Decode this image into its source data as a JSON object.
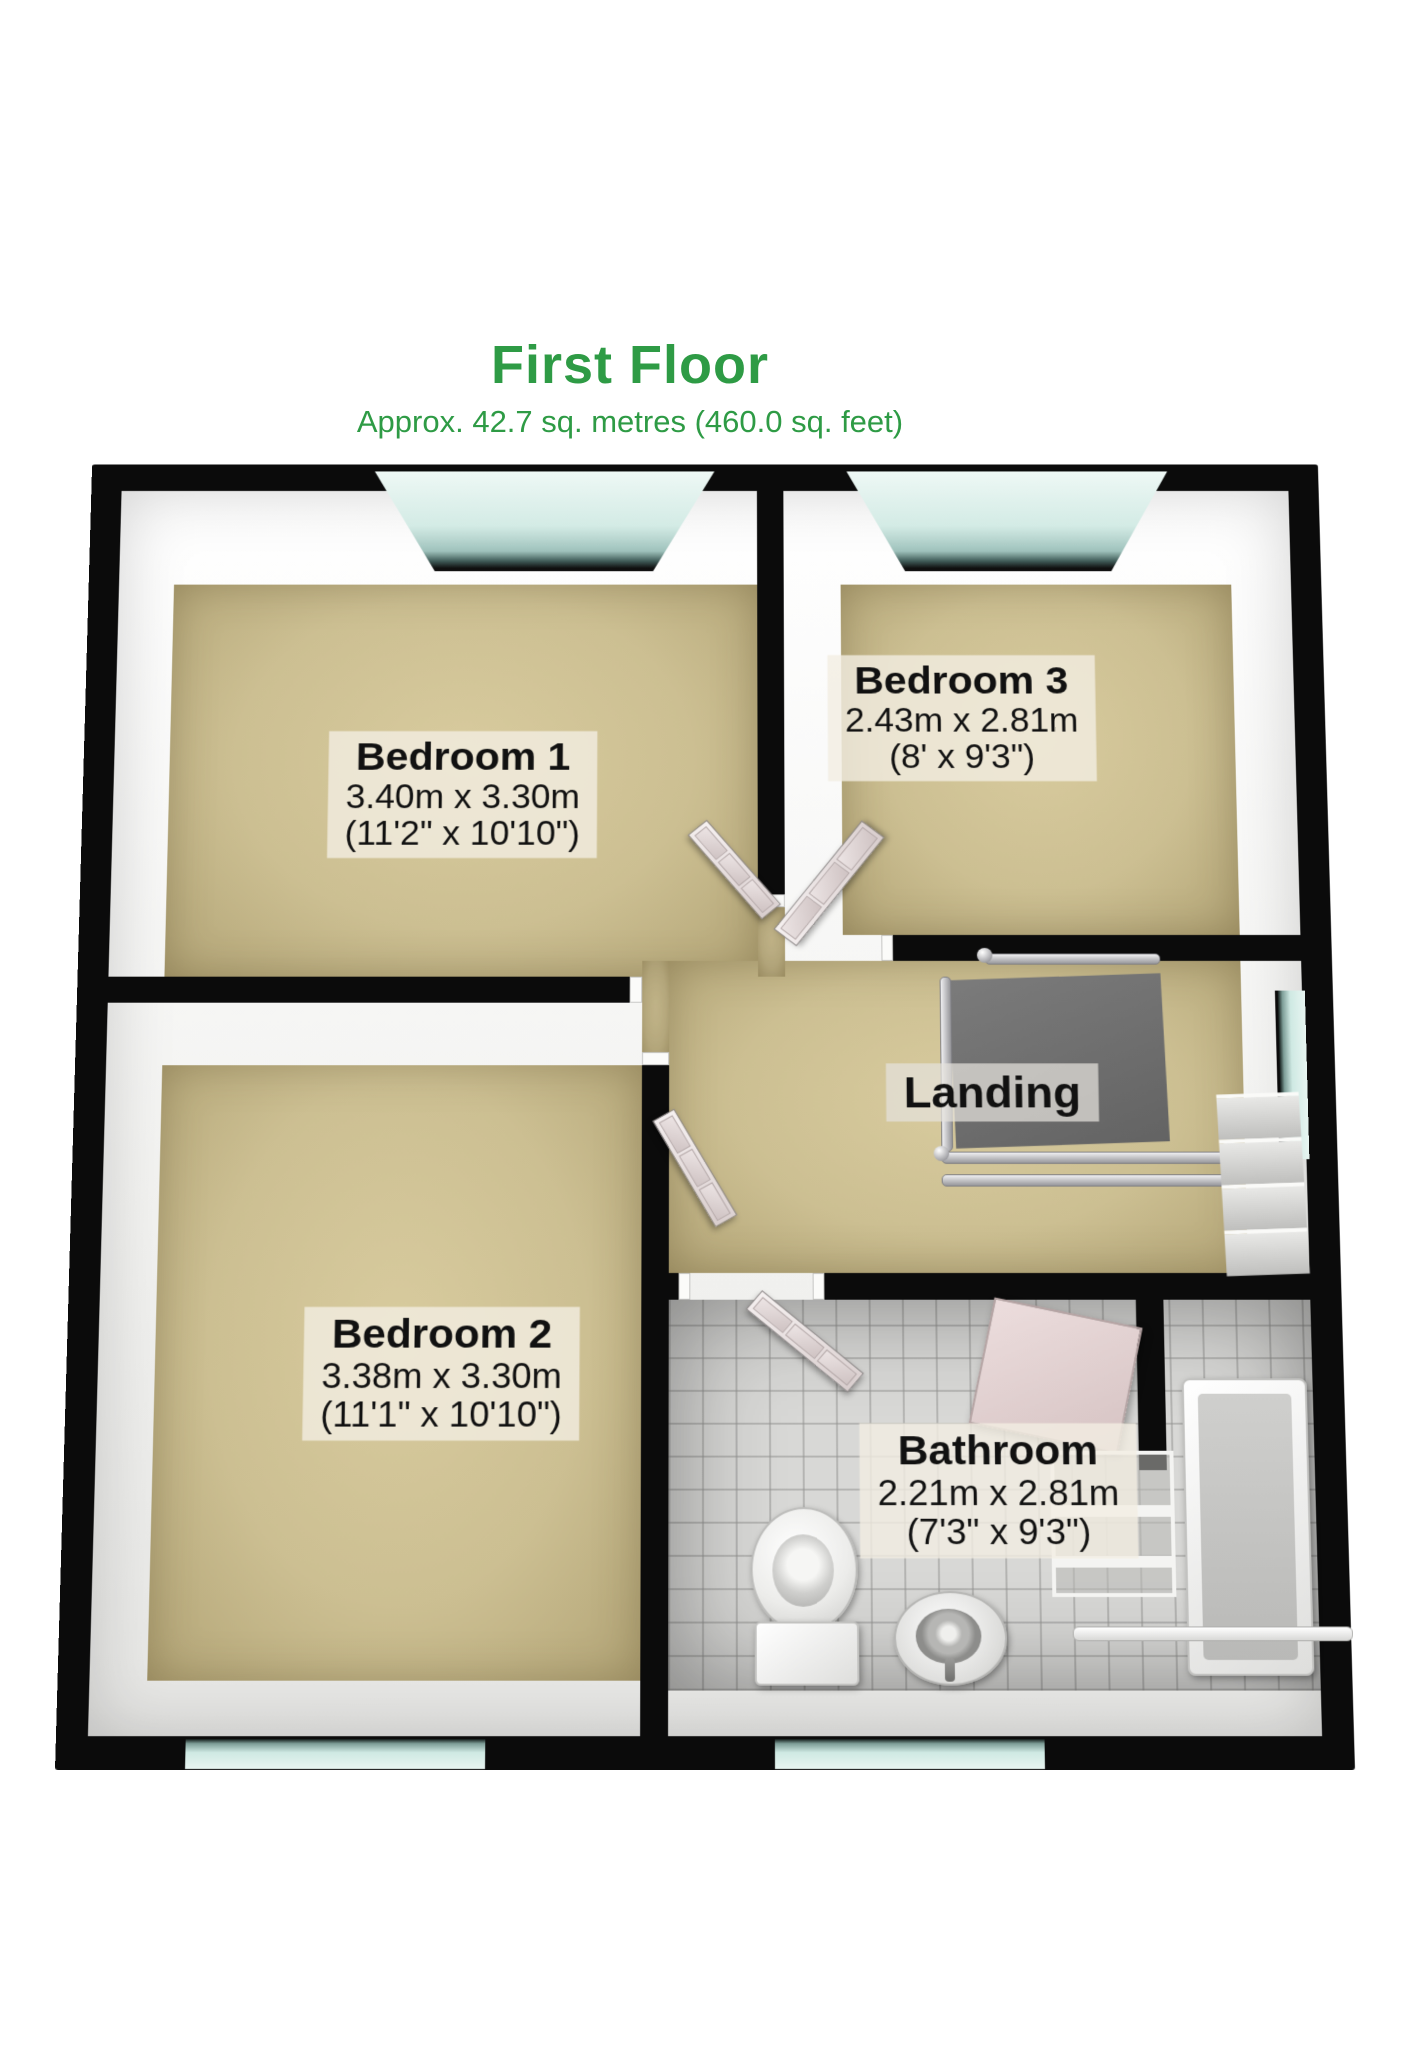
{
  "header": {
    "title": "First Floor",
    "subtitle": "Approx. 42.7 sq. metres (460.0 sq. feet)"
  },
  "rooms": {
    "bedroom1": {
      "name": "Bedroom 1",
      "metric": "3.40m x 3.30m",
      "imperial": "(11'2\" x 10'10\")"
    },
    "bedroom3": {
      "name": "Bedroom 3",
      "metric": "2.43m x 2.81m",
      "imperial": "(8' x 9'3\")"
    },
    "landing": {
      "name": "Landing"
    },
    "bedroom2": {
      "name": "Bedroom 2",
      "metric": "3.38m x 3.30m",
      "imperial": "(11'1\" x 10'10\")"
    },
    "bathroom": {
      "name": "Bathroom",
      "metric": "2.21m x 2.81m",
      "imperial": "(7'3\" x 9'3\")"
    }
  },
  "palette": {
    "accent_green": "#2e9b45",
    "wall_black": "#0b0b0b",
    "carpet_beige": "#ccbf92",
    "bathroom_tile": "#d8d8d6",
    "window_glass": "#cfe9e3",
    "stairwell_gray": "#707070",
    "label_text": "#111111"
  }
}
